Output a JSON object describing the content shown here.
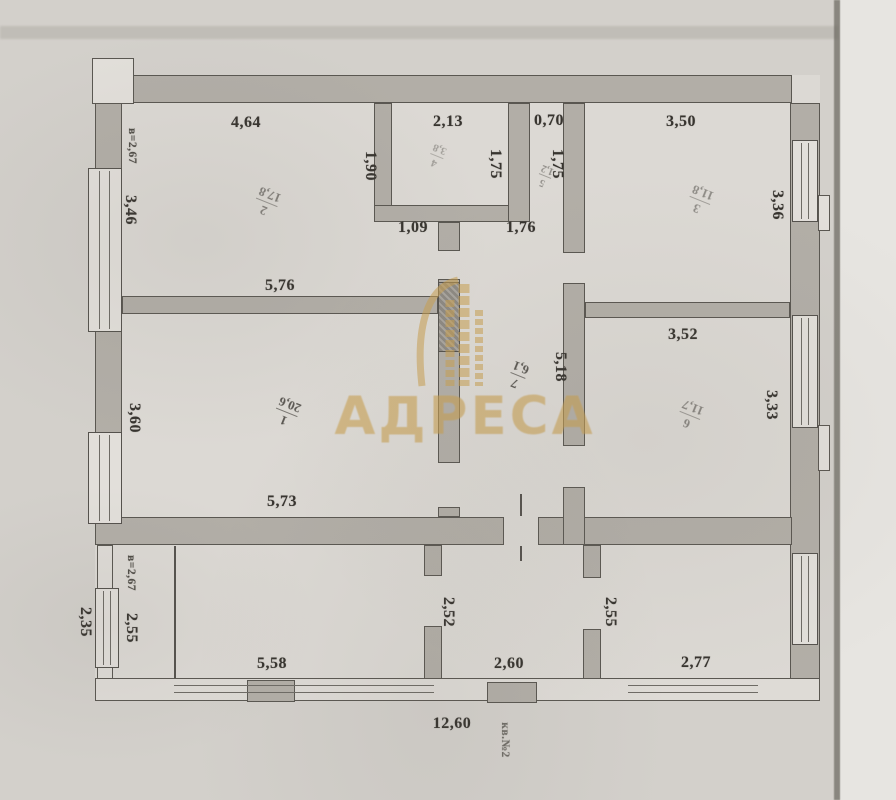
{
  "document": {
    "kind": "scanned floor plan (technical passport drawing)"
  },
  "colors": {
    "watermark_gold": "#c9a050",
    "ink": "#37342f",
    "wall_gray": "#b2aea7",
    "paper": "#d6d3ce"
  },
  "watermark": {
    "brand": "АДРЕСА",
    "logo_icon": "building-arch-logo"
  },
  "rooms": [
    {
      "number": "1",
      "area": "20,6"
    },
    {
      "number": "2",
      "area": "17,8"
    },
    {
      "number": "3",
      "area": "11,8"
    },
    {
      "number": "4",
      "area": "3,8"
    },
    {
      "number": "5",
      "area": "1,2"
    },
    {
      "number": "6",
      "area": "11,7"
    },
    {
      "number": "7",
      "area": "6,1"
    }
  ],
  "dims": {
    "room2_top": "4,64",
    "bath_top": "2,13",
    "wc_top": "0,70",
    "room3_top": "3,50",
    "bath_below_left": "1,09",
    "bath_below_right": "1,76",
    "room2_bottom": "5,76",
    "room6_top": "3,52",
    "room1_bottom": "5,73",
    "veranda_bottom_left": "5,58",
    "veranda_bottom_mid": "2,60",
    "veranda_bottom_right": "2,77",
    "total_width": "12,60",
    "ceiling_height_top": "в=2,67",
    "room2_left": "3,46",
    "bath_left": "1,90",
    "bath_right": "1,75",
    "wc_right": "1,75",
    "room3_right": "3,36",
    "hall_right": "5,18",
    "room6_right": "3,33",
    "room1_left": "3,60",
    "ceiling_height_veranda": "в=2,67",
    "veranda_left_outer": "2,35",
    "veranda_left_inner": "2,55",
    "veranda_part_left": "2,52",
    "veranda_part_right": "2,55",
    "apartment_no": "кв.№2"
  }
}
